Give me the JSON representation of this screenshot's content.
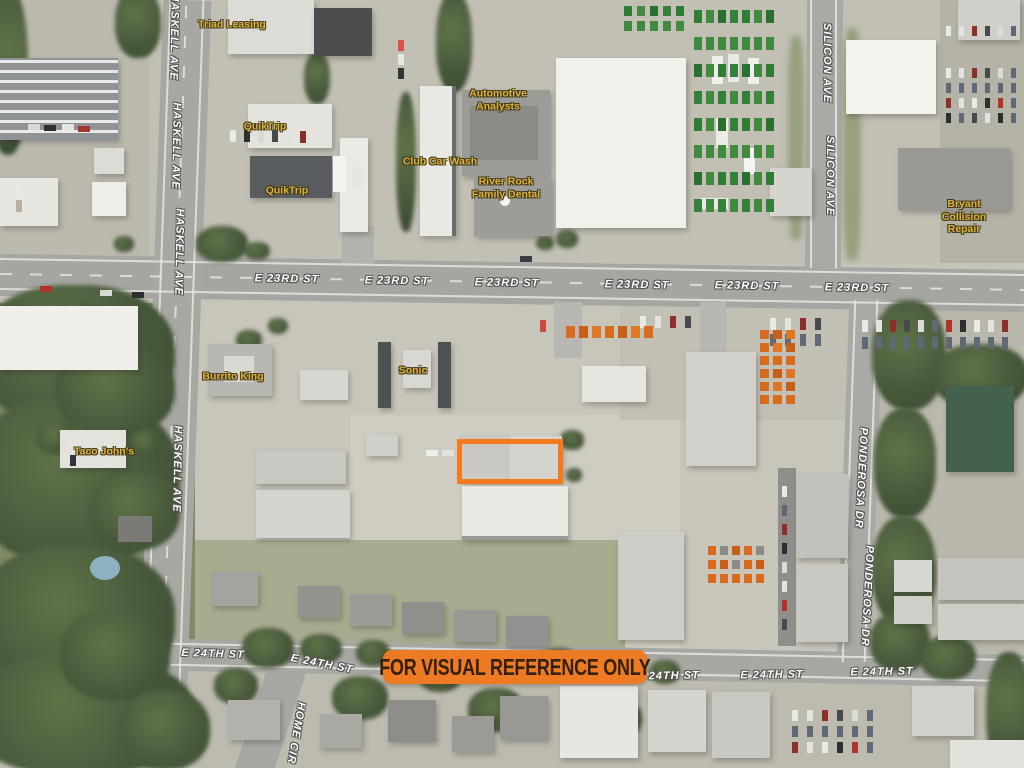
{
  "banner": {
    "text": "FOR VISUAL REFERENCE ONLY"
  },
  "colors": {
    "highlight_outline": "#F5791D",
    "banner_background": "#EE7A24",
    "banner_text": "#33210A",
    "street_label_text": "#FFFFFF",
    "business_label_text": "#DDB23E"
  },
  "highlight_box": {
    "x": 457,
    "y": 439,
    "width": 106,
    "height": 45
  },
  "street_labels": [
    {
      "text": "HASKELL AVE",
      "x": 174,
      "y": 37,
      "rot": 91
    },
    {
      "text": "HASKELL AVE",
      "x": 176,
      "y": 146,
      "rot": 91
    },
    {
      "text": "HASKELL AVE",
      "x": 179,
      "y": 252,
      "rot": 91
    },
    {
      "text": "HASKELL AVE",
      "x": 177,
      "y": 469,
      "rot": 91
    },
    {
      "text": "E 23RD ST",
      "x": 287,
      "y": 279,
      "rot": 1
    },
    {
      "text": "E 23RD ST",
      "x": 397,
      "y": 281,
      "rot": 1
    },
    {
      "text": "E 23RD ST",
      "x": 507,
      "y": 283,
      "rot": 1
    },
    {
      "text": "E 23RD ST",
      "x": 637,
      "y": 285,
      "rot": 1
    },
    {
      "text": "E 23RD ST",
      "x": 747,
      "y": 286,
      "rot": 1
    },
    {
      "text": "E 23RD ST",
      "x": 857,
      "y": 288,
      "rot": 1
    },
    {
      "text": "SILICON AVE",
      "x": 827,
      "y": 63,
      "rot": 90
    },
    {
      "text": "SILICON AVE",
      "x": 830,
      "y": 176,
      "rot": 90
    },
    {
      "text": "PONDEROSA DR",
      "x": 861,
      "y": 478,
      "rot": 93
    },
    {
      "text": "PONDEROSA DR",
      "x": 867,
      "y": 596,
      "rot": 93
    },
    {
      "text": "E 24TH ST",
      "x": 213,
      "y": 654,
      "rot": 2
    },
    {
      "text": "E 24TH ST",
      "x": 322,
      "y": 664,
      "rot": 11
    },
    {
      "text": "E 24TH ST",
      "x": 668,
      "y": 676,
      "rot": -1
    },
    {
      "text": "E 24TH ST",
      "x": 772,
      "y": 675,
      "rot": -1
    },
    {
      "text": "E 24TH ST",
      "x": 882,
      "y": 672,
      "rot": -1
    },
    {
      "text": "HOME CIR",
      "x": 296,
      "y": 733,
      "rot": 100
    }
  ],
  "business_labels": [
    {
      "text": "Triad Leasing",
      "x": 232,
      "y": 25
    },
    {
      "text": "Automotive\nAnalysts",
      "x": 498,
      "y": 100
    },
    {
      "text": "QuikTrip",
      "x": 265,
      "y": 127
    },
    {
      "text": "QuikTrip",
      "x": 287,
      "y": 191
    },
    {
      "text": "Club Car Wash",
      "x": 440,
      "y": 162
    },
    {
      "text": "River Rock\nFamily Dental",
      "x": 506,
      "y": 188
    },
    {
      "text": "Bryant Collision\nRepair",
      "x": 964,
      "y": 217
    },
    {
      "text": "Burrito King",
      "x": 233,
      "y": 377
    },
    {
      "text": "Sonic",
      "x": 413,
      "y": 371
    },
    {
      "text": "Taco John's",
      "x": 104,
      "y": 452
    }
  ]
}
